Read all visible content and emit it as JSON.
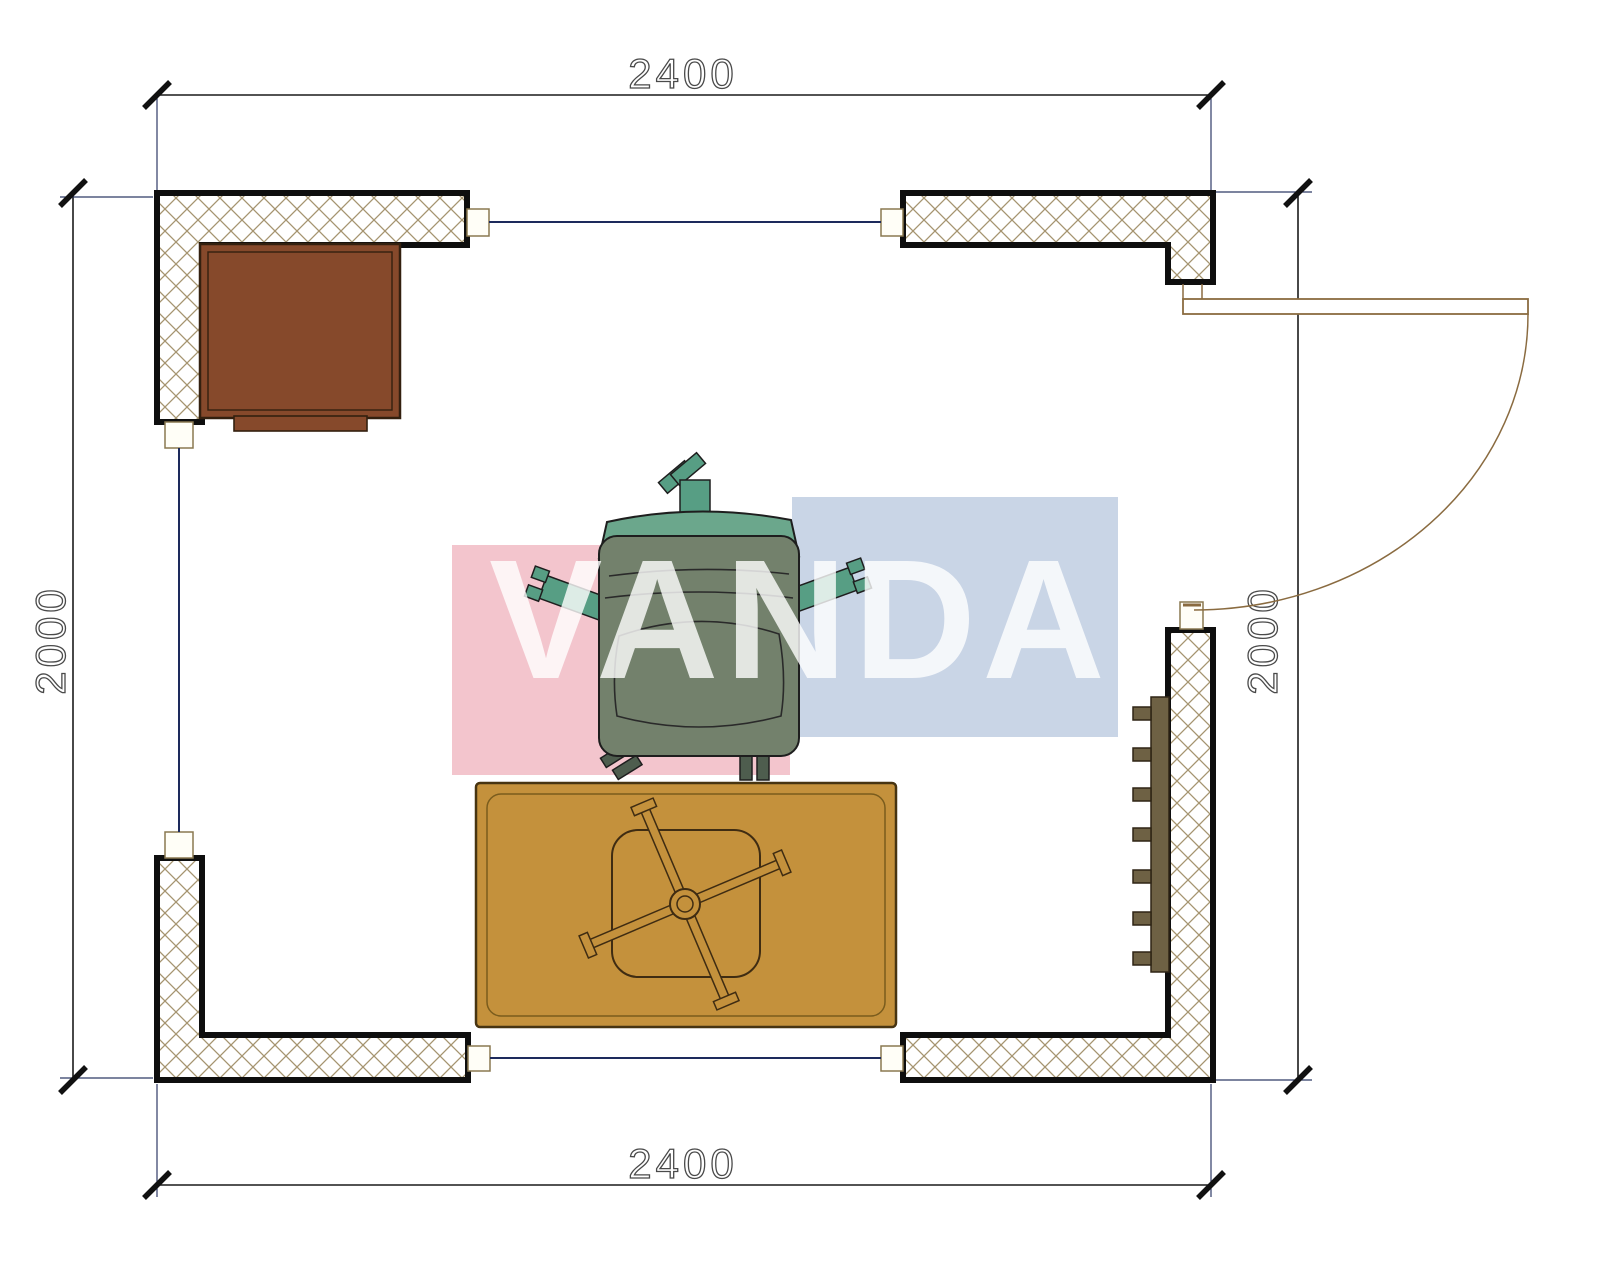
{
  "drawing": {
    "type": "floor-plan",
    "dimensions": {
      "top": "2400",
      "bottom": "2400",
      "left": "2000",
      "right": "2000"
    },
    "watermark": {
      "text": "VANDA",
      "pink_block": "#F3C5CD",
      "blue_block": "#C9D5E6",
      "text_color": "rgba(255,255,255,0.8)"
    },
    "colors": {
      "wall_outline": "#0e0e0e",
      "wall_fill": "#ffffff",
      "hatch_line": "#a5946f",
      "cap_fill": "#fffef7",
      "cap_stroke": "#8a7850",
      "opening_line": "#1d2a5c",
      "dimension_line": "#1a1a1a",
      "extension_line": "#2e3a66",
      "door": "#8a6b40",
      "cabinet": "#86492B",
      "cabinet_stroke": "#33200f",
      "rug": "#C4913C",
      "rug_stroke": "#473411",
      "table_stroke": "#3f2c12",
      "radiator": "#6e6144",
      "chair_back": "#6BA78C",
      "chair_seat": "#73816C",
      "chair_arm": "#579E84",
      "chair_outline": "#1e1e1e"
    },
    "furniture": {
      "cabinet": "cabinet",
      "armchair": "armchair",
      "rug": "rug",
      "table": "pinwheel-table",
      "radiator": "radiator",
      "door": "door-swing"
    }
  }
}
